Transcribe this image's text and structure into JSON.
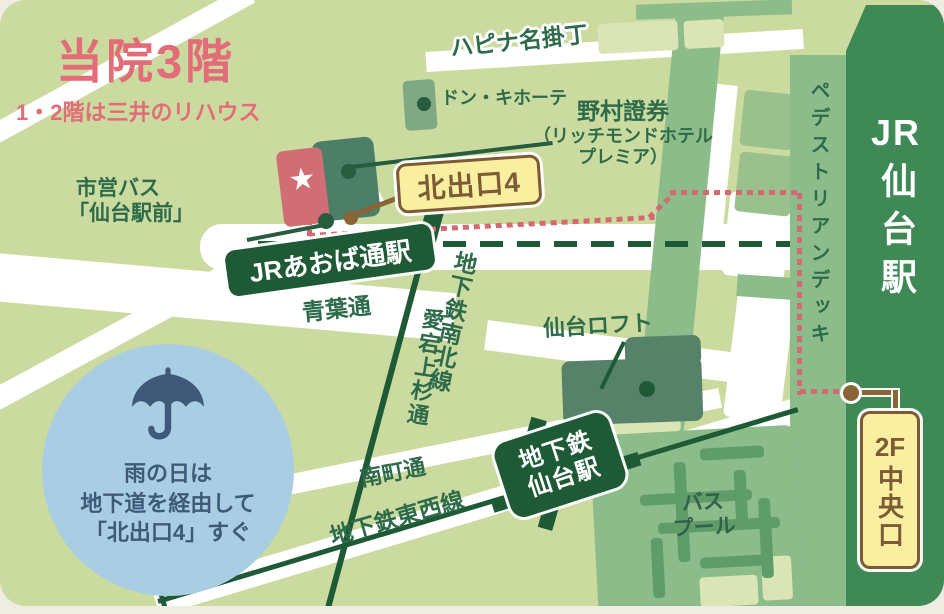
{
  "title": {
    "main": "当院3階",
    "sub": "1・2階は三井のリハウス"
  },
  "landmarks": {
    "arcade": "ハピナ名掛丁",
    "donki": "ドン・キホーテ",
    "nomura1": "野村證券",
    "nomura2": "（リッチモンドホテル",
    "nomura3": "プレミア）",
    "bus_stop1": "市営バス",
    "bus_stop2": "「仙台駅前」",
    "loft": "仙台ロフト",
    "bus_pool1": "バス",
    "bus_pool2": "プール"
  },
  "stations": {
    "aobadori": "JRあおば通駅",
    "jr_prefix": "JR",
    "jr_kanji": "仙台駅",
    "subway1": "地下鉄",
    "subway2": "仙台駅"
  },
  "exits": {
    "north": "北出口4",
    "central_prefix": "2F",
    "central_kanji": "中央口"
  },
  "streets": {
    "aoba": "青葉通",
    "atago": "愛宕上杉通",
    "namboku": "地下鉄南北線",
    "minamimachi": "南町通",
    "tozai": "地下鉄東西線",
    "deck": "ペデストリアンデッキ"
  },
  "rain": {
    "line1": "雨の日は",
    "line2": "地下道を経由して",
    "line3": "「北出口4」すぐ"
  },
  "marker": {
    "star": "★"
  },
  "colors": {
    "map_bg": "#cbdb9f",
    "road_white": "#ffffff",
    "accent_pink": "#e26c77",
    "clinic_red": "#d06d75",
    "route_pink": "#d56973",
    "line_dark_green": "#1d5a35",
    "label_green": "#2e6b4b",
    "deck_green": "#8dbc8b",
    "building_green": "#568269",
    "jr_station_green": "#3e8955",
    "exit_yellow": "#f8f0a0",
    "exit_brown": "#7d5b36",
    "rain_circle_blue": "#a9cee3",
    "rain_text_blue": "#3f5a78"
  }
}
